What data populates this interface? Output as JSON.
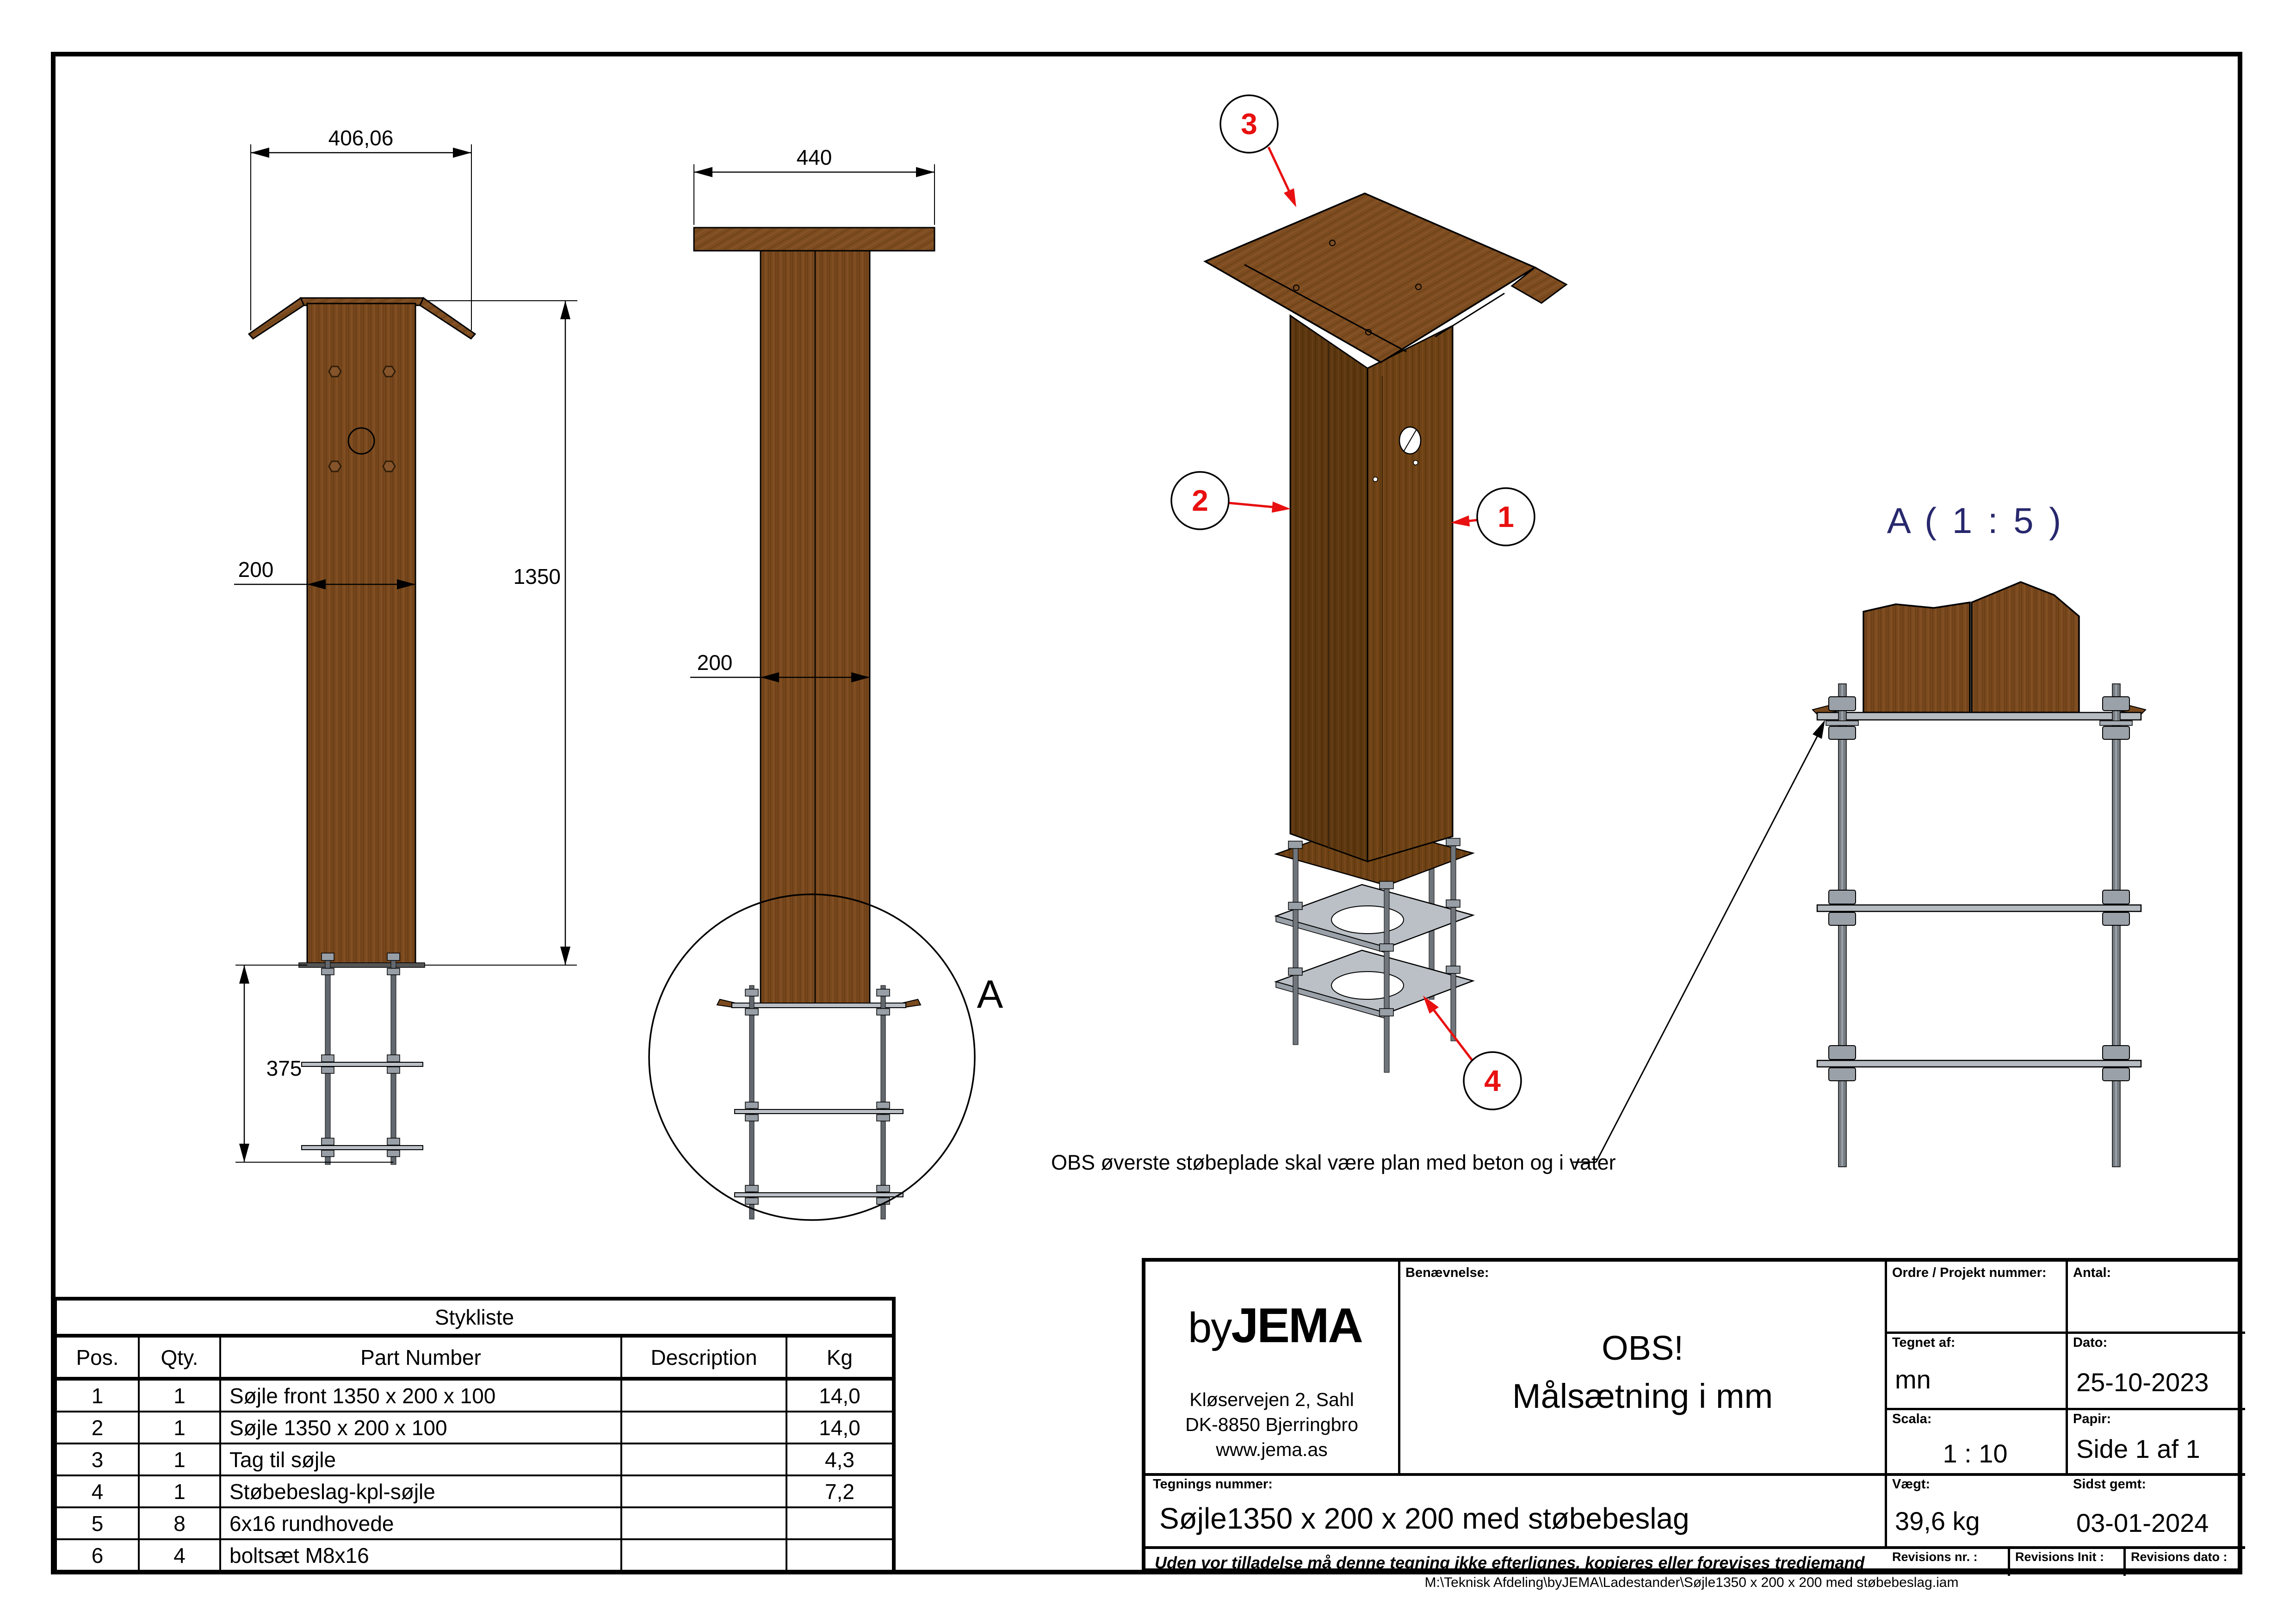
{
  "front_view": {
    "dim_top_width": "406,06",
    "dim_width": "200",
    "dim_height": "1350",
    "dim_anchor": "375"
  },
  "side_view": {
    "dim_plate": "440",
    "dim_width": "200",
    "detail_label": "A"
  },
  "iso_view": {
    "balloons": [
      "1",
      "2",
      "3",
      "4"
    ],
    "note": "OBS øverste støbeplade skal være plan med beton og i vater"
  },
  "detail_view": {
    "title": "A ( 1 : 5 )"
  },
  "colors": {
    "wood": "#7a4a1e",
    "wood_dark": "#5c370f",
    "wood_mid": "#6e4215",
    "plate_gray": "#bac0c6",
    "balloon_red": "#e81010",
    "detail_title_navy": "#28286e"
  },
  "stykliste": {
    "title": "Stykliste",
    "headers": {
      "pos": "Pos.",
      "qty": "Qty.",
      "part": "Part Number",
      "desc": "Description",
      "kg": "Kg"
    },
    "rows": [
      {
        "pos": "1",
        "qty": "1",
        "part": "Søjle front 1350 x 200 x 100",
        "desc": "",
        "kg": "14,0"
      },
      {
        "pos": "2",
        "qty": "1",
        "part": "Søjle 1350 x 200 x 100",
        "desc": "",
        "kg": "14,0"
      },
      {
        "pos": "3",
        "qty": "1",
        "part": "Tag til søjle",
        "desc": "",
        "kg": "4,3"
      },
      {
        "pos": "4",
        "qty": "1",
        "part": "Støbebeslag-kpl-søjle",
        "desc": "",
        "kg": "7,2"
      },
      {
        "pos": "5",
        "qty": "8",
        "part": "6x16 rundhovede",
        "desc": "",
        "kg": ""
      },
      {
        "pos": "6",
        "qty": "4",
        "part": "boltsæt M8x16",
        "desc": "",
        "kg": ""
      }
    ]
  },
  "title_block": {
    "logo": {
      "by": "by",
      "jema": "JEMA",
      "address1": "Kløservejen 2, Sahl",
      "address2": "DK-8850 Bjerringbro",
      "address3": "www.jema.as"
    },
    "labels": {
      "benaevnelse": "Benævnelse:",
      "ordre": "Ordre / Projekt nummer:",
      "antal": "Antal:",
      "tegnet_af": "Tegnet af:",
      "dato": "Dato:",
      "scala": "Scala:",
      "papir": "Papir:",
      "tegnings_nummer": "Tegnings nummer:",
      "vaegt": "Vægt:",
      "sidst_gemt": "Sidst gemt:",
      "rev_nr": "Revisions nr. :",
      "rev_init": "Revisions Init :",
      "rev_dato": "Revisions dato :"
    },
    "values": {
      "benaevnelse_line1": "OBS!",
      "benaevnelse_line2": "Målsætning i mm",
      "tegnet_af": "mn",
      "dato": "25-10-2023",
      "scala": "1 : 10",
      "papir": "Side 1 af 1",
      "tegnings_nummer": "Søjle1350 x 200 x 200 med støbebeslag",
      "vaegt": "39,6 kg",
      "sidst_gemt": "03-01-2024"
    },
    "disclaimer": "Uden vor tilladelse må denne tegning ikke efterlignes, kopieres eller forevises tredjemand"
  },
  "footer": {
    "path": "M:\\Teknisk Afdeling\\byJEMA\\Ladestander\\Søjle1350 x 200 x 200 med støbebeslag.iam"
  }
}
